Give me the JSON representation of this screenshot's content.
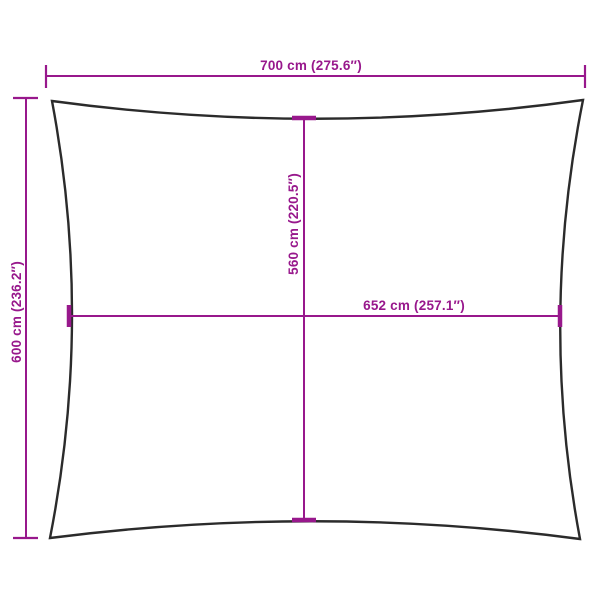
{
  "diagram": {
    "kind": "product-dimension-diagram",
    "subject": "rectangular shade sail outline with concave edges",
    "colors": {
      "accent": "#98188c",
      "outline": "#2b2b2b",
      "background": "#ffffff"
    },
    "dims": {
      "top_width": {
        "label": "700 cm (275.6″)",
        "value_cm": 700,
        "value_in": 275.6
      },
      "left_height": {
        "label": "600 cm (236.2″)",
        "value_cm": 600,
        "value_in": 236.2
      },
      "inner_height": {
        "label": "560 cm (220.5″)",
        "value_cm": 560,
        "value_in": 220.5
      },
      "inner_width": {
        "label": "652 cm (257.1″)",
        "value_cm": 652,
        "value_in": 257.1
      }
    }
  }
}
